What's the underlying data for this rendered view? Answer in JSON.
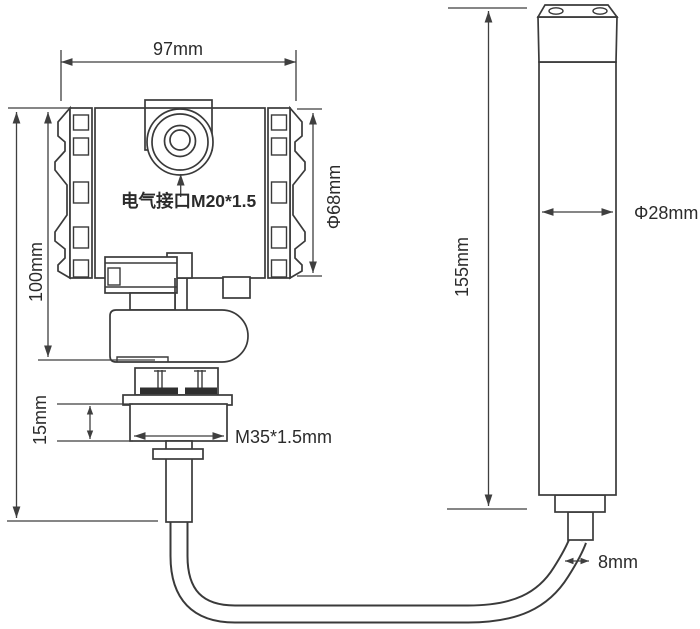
{
  "diagram": {
    "labels": {
      "head_width": "97mm",
      "head_height": "100mm",
      "electrical_port": "电气接口M20*1.5",
      "head_diameter": "Φ68mm",
      "probe_length": "155mm",
      "nut_height": "15mm",
      "thread_spec": "M35*1.5mm",
      "probe_diameter": "Φ28mm",
      "cable_diameter": "8mm"
    },
    "colors": {
      "line": "#3a3a3a",
      "dimension_line": "#3f3f3f",
      "text": "#2b2b2b",
      "background": "#ffffff",
      "bolt_fill": "#2f2f2f"
    }
  }
}
